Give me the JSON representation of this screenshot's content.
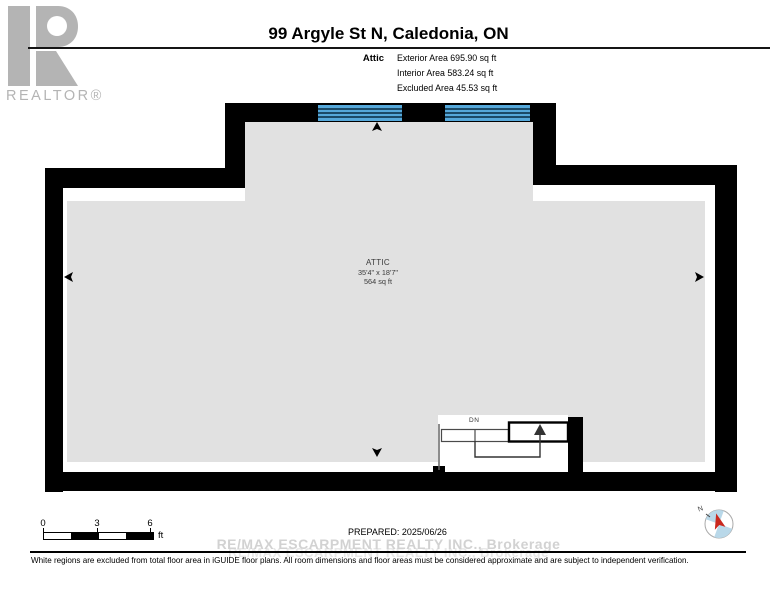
{
  "colors": {
    "wall": "#000000",
    "room_fill": "#e1e1e1",
    "window_blue": "#55a8da",
    "window_line": "#1b4a67",
    "logo_gray": "#b4b4b4",
    "compass_blue": "#b9d8e9",
    "compass_red": "#c9281e"
  },
  "logo": {
    "wordmark": "REALTOR®"
  },
  "header": {
    "title": "99 Argyle St N, Caledonia, ON",
    "floor_label": "Attic",
    "stats": [
      "Exterior Area 695.90 sq ft",
      "Interior Area 583.24 sq ft",
      "Excluded Area 45.53 sq ft"
    ]
  },
  "room": {
    "name": "ATTIC",
    "dimensions": "35'4\" x 18'7\"",
    "area": "564 sq ft"
  },
  "stairs": {
    "down_label": "DN"
  },
  "scale_bar": {
    "tick_0": "0",
    "tick_3": "3",
    "tick_6": "6",
    "unit": "ft"
  },
  "compass": {
    "north": "N"
  },
  "footer": {
    "prepared": "PREPARED: 2025/06/26",
    "watermark_line1": "RE/MAX ESCARPMENT REALTY INC., Brokerage",
    "watermark_line2": "RE/MAX ESCARPMENT REALTY INC., Brokerage",
    "disclaimer": "White regions are excluded from total floor area in iGUIDE floor plans. All room dimensions and floor areas must be considered approximate and are subject to independent verification."
  }
}
